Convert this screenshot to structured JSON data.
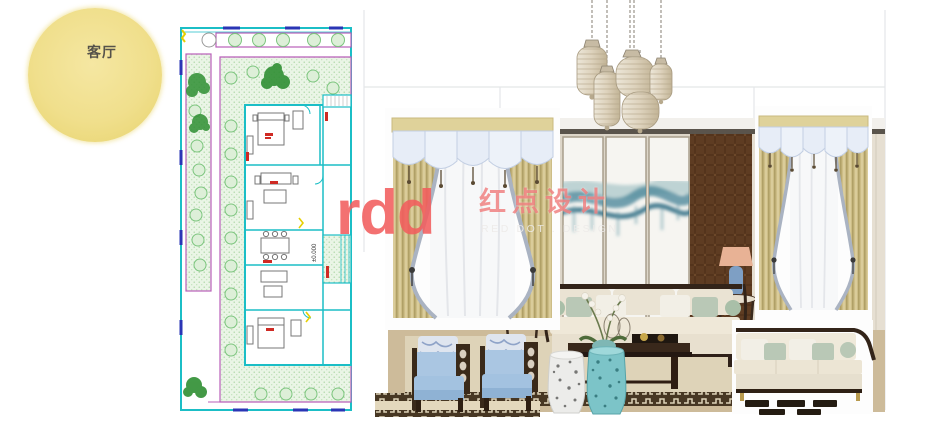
{
  "page": {
    "width": 945,
    "height": 427,
    "background": "#ffffff"
  },
  "room_bubble": {
    "label": "客厅",
    "fill": "#f0df8c",
    "text_color": "#55524a"
  },
  "floor_plan": {
    "elevation_label": "±0.000",
    "colors": {
      "wall_cyan": "#1bbec6",
      "garden_border_magenta": "#b95fb9",
      "hatch_fill": "#eaf5e6",
      "hatch_dot": "#a8d4a2",
      "shrub_stroke": "#7cc57e",
      "tree_green": "#2f8f33",
      "window_navy": "#2a35b5",
      "room_label_red": "#cf2a24",
      "door_accent_yellow": "#e6cf00"
    }
  },
  "moodboard": {
    "grid_color": "#e4e6e8",
    "items": [
      {
        "name": "pendant-lantern-cluster",
        "count": 5,
        "color": "#d9cfbc"
      },
      {
        "name": "curtain-left",
        "style": "scalloped-valance",
        "drape_color": "#c3b37c",
        "flap_color": "#e7edf7"
      },
      {
        "name": "curtain-right",
        "style": "scalloped-valance",
        "drape_color": "#c3b37c",
        "flap_color": "#e7edf7"
      },
      {
        "name": "interior-render",
        "art": "teal-ink-landscape-panels",
        "wood_color": "#5e3c22"
      },
      {
        "name": "armchair-pair",
        "color": "#a3c2e0"
      },
      {
        "name": "garden-stool-white",
        "color": "#ececea"
      },
      {
        "name": "garden-stool-turquoise",
        "color": "#7cc4c8"
      },
      {
        "name": "sofa-product",
        "color": "#efe9da"
      }
    ]
  },
  "watermark": {
    "logo": "rdd",
    "cn": "红点设计",
    "en": "RED DOT . DESIGN",
    "logo_color": "#f25e5e"
  }
}
